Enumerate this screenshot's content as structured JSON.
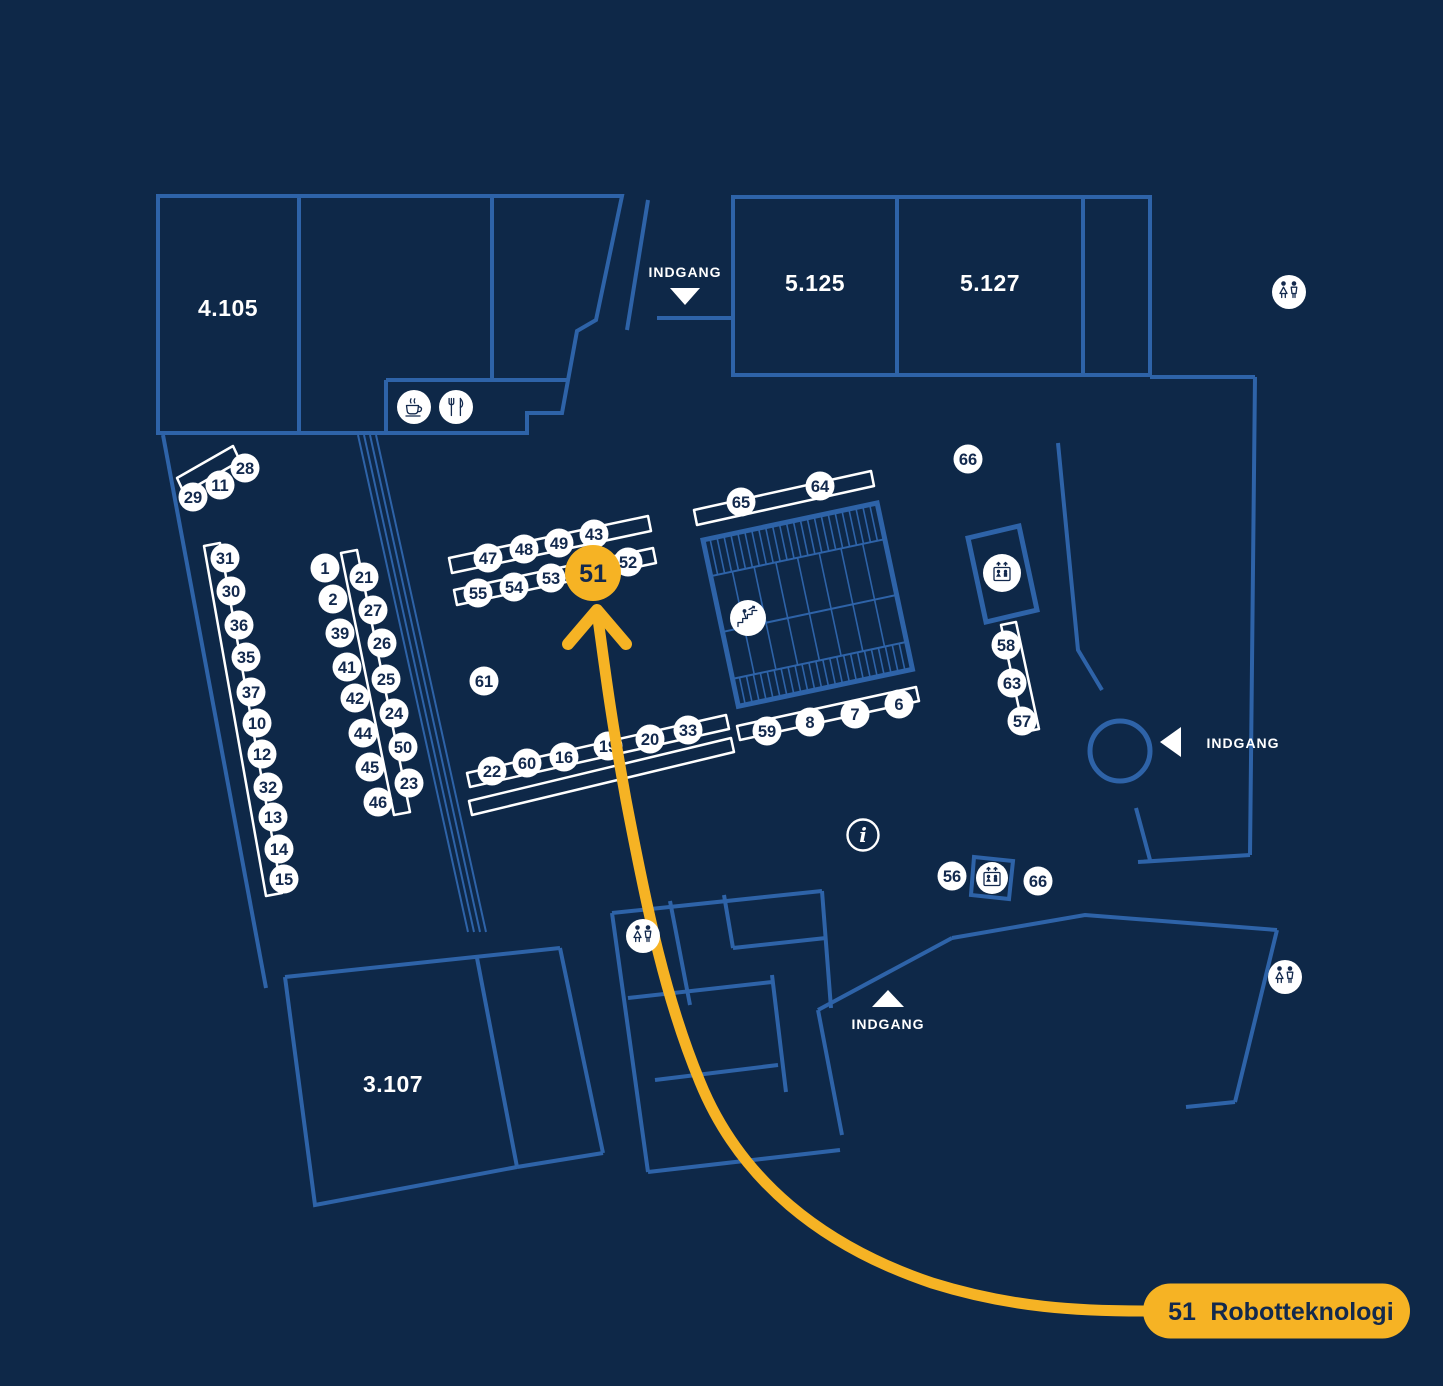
{
  "map": {
    "colors": {
      "background": "#0E2848",
      "wall_blue": "#2E63A8",
      "accent_yellow": "#F6B324",
      "marker_text_navy": "#13294D",
      "white": "#FFFFFF"
    },
    "rooms": [
      {
        "label": "4.105",
        "x": 228,
        "y": 316
      },
      {
        "label": "5.125",
        "x": 815,
        "y": 291
      },
      {
        "label": "5.127",
        "x": 990,
        "y": 291
      },
      {
        "label": "3.107",
        "x": 393,
        "y": 1092
      }
    ],
    "entrances": [
      {
        "label": "INDGANG",
        "dir": "down",
        "tx": 685,
        "ty": 277,
        "ax": 685,
        "ay": 296
      },
      {
        "label": "INDGANG",
        "dir": "left",
        "tx": 1243,
        "ty": 748,
        "ax": 1172,
        "ay": 742
      },
      {
        "label": "INDGANG",
        "dir": "up",
        "tx": 888,
        "ty": 1029,
        "ax": 888,
        "ay": 999
      }
    ],
    "markers": [
      {
        "label": "29",
        "x": 193,
        "y": 497
      },
      {
        "label": "11",
        "x": 220,
        "y": 485
      },
      {
        "label": "28",
        "x": 245,
        "y": 468
      },
      {
        "label": "31",
        "x": 225,
        "y": 558
      },
      {
        "label": "30",
        "x": 231,
        "y": 591
      },
      {
        "label": "36",
        "x": 239,
        "y": 625
      },
      {
        "label": "35",
        "x": 246,
        "y": 657
      },
      {
        "label": "37",
        "x": 251,
        "y": 692
      },
      {
        "label": "10",
        "x": 257,
        "y": 723
      },
      {
        "label": "12",
        "x": 262,
        "y": 754
      },
      {
        "label": "32",
        "x": 268,
        "y": 787
      },
      {
        "label": "13",
        "x": 273,
        "y": 817
      },
      {
        "label": "14",
        "x": 279,
        "y": 849
      },
      {
        "label": "15",
        "x": 284,
        "y": 879
      },
      {
        "label": "1",
        "x": 325,
        "y": 568
      },
      {
        "label": "2",
        "x": 333,
        "y": 599
      },
      {
        "label": "39",
        "x": 340,
        "y": 633
      },
      {
        "label": "41",
        "x": 347,
        "y": 667
      },
      {
        "label": "42",
        "x": 355,
        "y": 698
      },
      {
        "label": "44",
        "x": 363,
        "y": 733
      },
      {
        "label": "45",
        "x": 370,
        "y": 767
      },
      {
        "label": "46",
        "x": 378,
        "y": 802
      },
      {
        "label": "21",
        "x": 364,
        "y": 577
      },
      {
        "label": "27",
        "x": 373,
        "y": 610
      },
      {
        "label": "26",
        "x": 382,
        "y": 643
      },
      {
        "label": "25",
        "x": 386,
        "y": 679
      },
      {
        "label": "24",
        "x": 394,
        "y": 713
      },
      {
        "label": "50",
        "x": 403,
        "y": 747
      },
      {
        "label": "23",
        "x": 409,
        "y": 783
      },
      {
        "label": "47",
        "x": 488,
        "y": 558
      },
      {
        "label": "48",
        "x": 524,
        "y": 549
      },
      {
        "label": "49",
        "x": 559,
        "y": 543
      },
      {
        "label": "43",
        "x": 594,
        "y": 534
      },
      {
        "label": "52",
        "x": 628,
        "y": 562
      },
      {
        "label": "55",
        "x": 478,
        "y": 593
      },
      {
        "label": "54",
        "x": 514,
        "y": 587
      },
      {
        "label": "53",
        "x": 551,
        "y": 578
      },
      {
        "label": "61",
        "x": 484,
        "y": 681
      },
      {
        "label": "22",
        "x": 492,
        "y": 771
      },
      {
        "label": "60",
        "x": 527,
        "y": 763
      },
      {
        "label": "16",
        "x": 564,
        "y": 757
      },
      {
        "label": "19",
        "x": 608,
        "y": 746
      },
      {
        "label": "20",
        "x": 650,
        "y": 739
      },
      {
        "label": "33",
        "x": 688,
        "y": 730
      },
      {
        "label": "65",
        "x": 741,
        "y": 502
      },
      {
        "label": "64",
        "x": 820,
        "y": 486
      },
      {
        "label": "66",
        "x": 968,
        "y": 459
      },
      {
        "label": "59",
        "x": 767,
        "y": 731
      },
      {
        "label": "8",
        "x": 810,
        "y": 722
      },
      {
        "label": "7",
        "x": 855,
        "y": 714
      },
      {
        "label": "6",
        "x": 899,
        "y": 704
      },
      {
        "label": "58",
        "x": 1006,
        "y": 645
      },
      {
        "label": "63",
        "x": 1012,
        "y": 683
      },
      {
        "label": "57",
        "x": 1022,
        "y": 721
      },
      {
        "label": "56",
        "x": 952,
        "y": 876
      },
      {
        "label": "66",
        "x": 1038,
        "y": 881
      }
    ],
    "icons": [
      {
        "name": "coffee-icon",
        "x": 414,
        "y": 407,
        "r": 17
      },
      {
        "name": "restaurant-icon",
        "x": 456,
        "y": 407,
        "r": 17
      },
      {
        "name": "toilet-icon",
        "x": 1289,
        "y": 292,
        "r": 17
      },
      {
        "name": "toilet-icon",
        "x": 643,
        "y": 936,
        "r": 17
      },
      {
        "name": "toilet-icon",
        "x": 1285,
        "y": 977,
        "r": 17
      },
      {
        "name": "elevator-icon",
        "x": 1002,
        "y": 573,
        "r": 19
      },
      {
        "name": "elevator-icon",
        "x": 992,
        "y": 878,
        "r": 16
      },
      {
        "name": "stairs-icon",
        "x": 748,
        "y": 618,
        "r": 18
      },
      {
        "name": "info-icon",
        "x": 863,
        "y": 835,
        "r": 15.5
      }
    ],
    "highlight": {
      "label": "51",
      "x": 593,
      "y": 573
    },
    "legend": {
      "number": "51",
      "name": "Robotteknologi"
    }
  }
}
